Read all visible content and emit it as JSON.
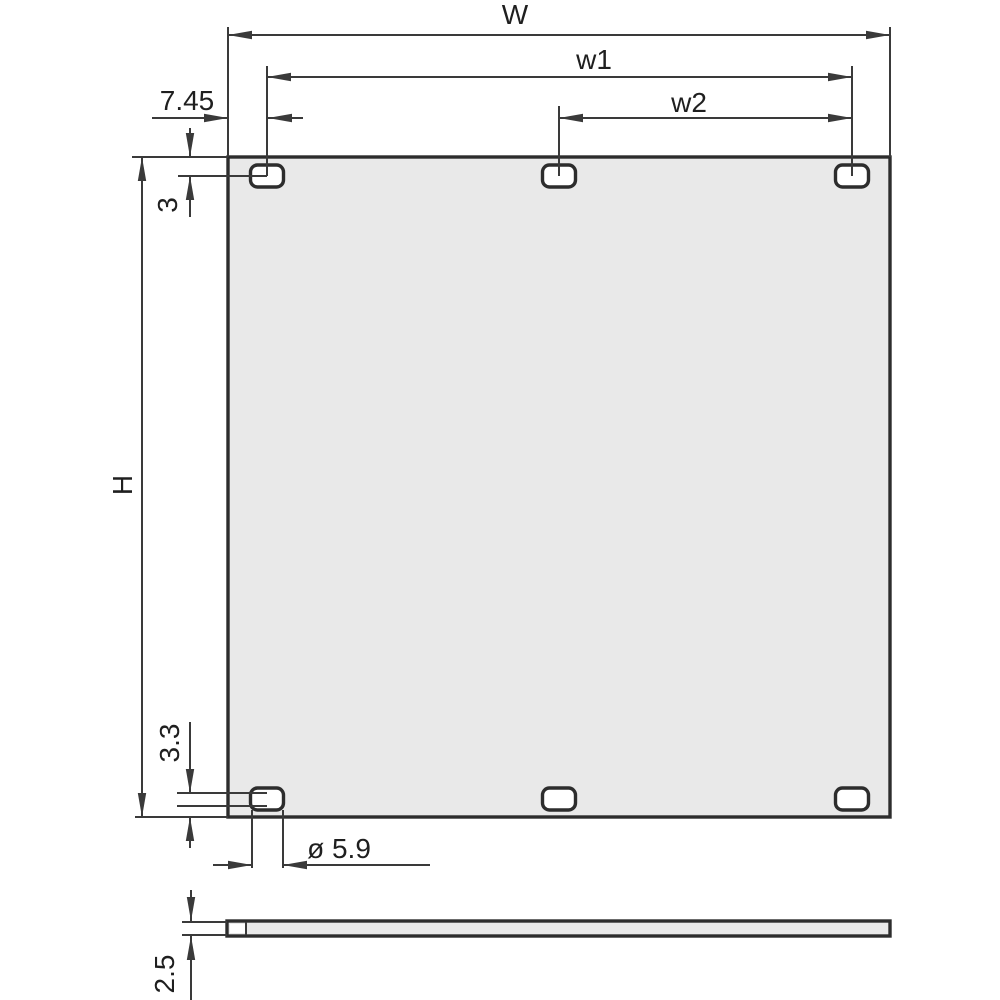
{
  "drawing": {
    "type": "technical-dimension-drawing",
    "subject": "front panel with six mounting slots, front view and side (thickness) view",
    "labels": {
      "W": "W",
      "w1": "w1",
      "w2": "w2",
      "edge_to_hole_x": "7.45",
      "top_edge_to_hole_y": "3",
      "H": "H",
      "bottom_edge_to_hole_y": "3.3",
      "hole_diameter": "ø 5.9",
      "thickness": "2.5"
    },
    "colors": {
      "line": "#3a3a3a",
      "outline": "#2d2d2d",
      "panel_fill": "#e9e9e9",
      "hole_fill": "#ffffff",
      "text": "#1f1f1f",
      "background": "#ffffff"
    },
    "hole_count": 6
  }
}
